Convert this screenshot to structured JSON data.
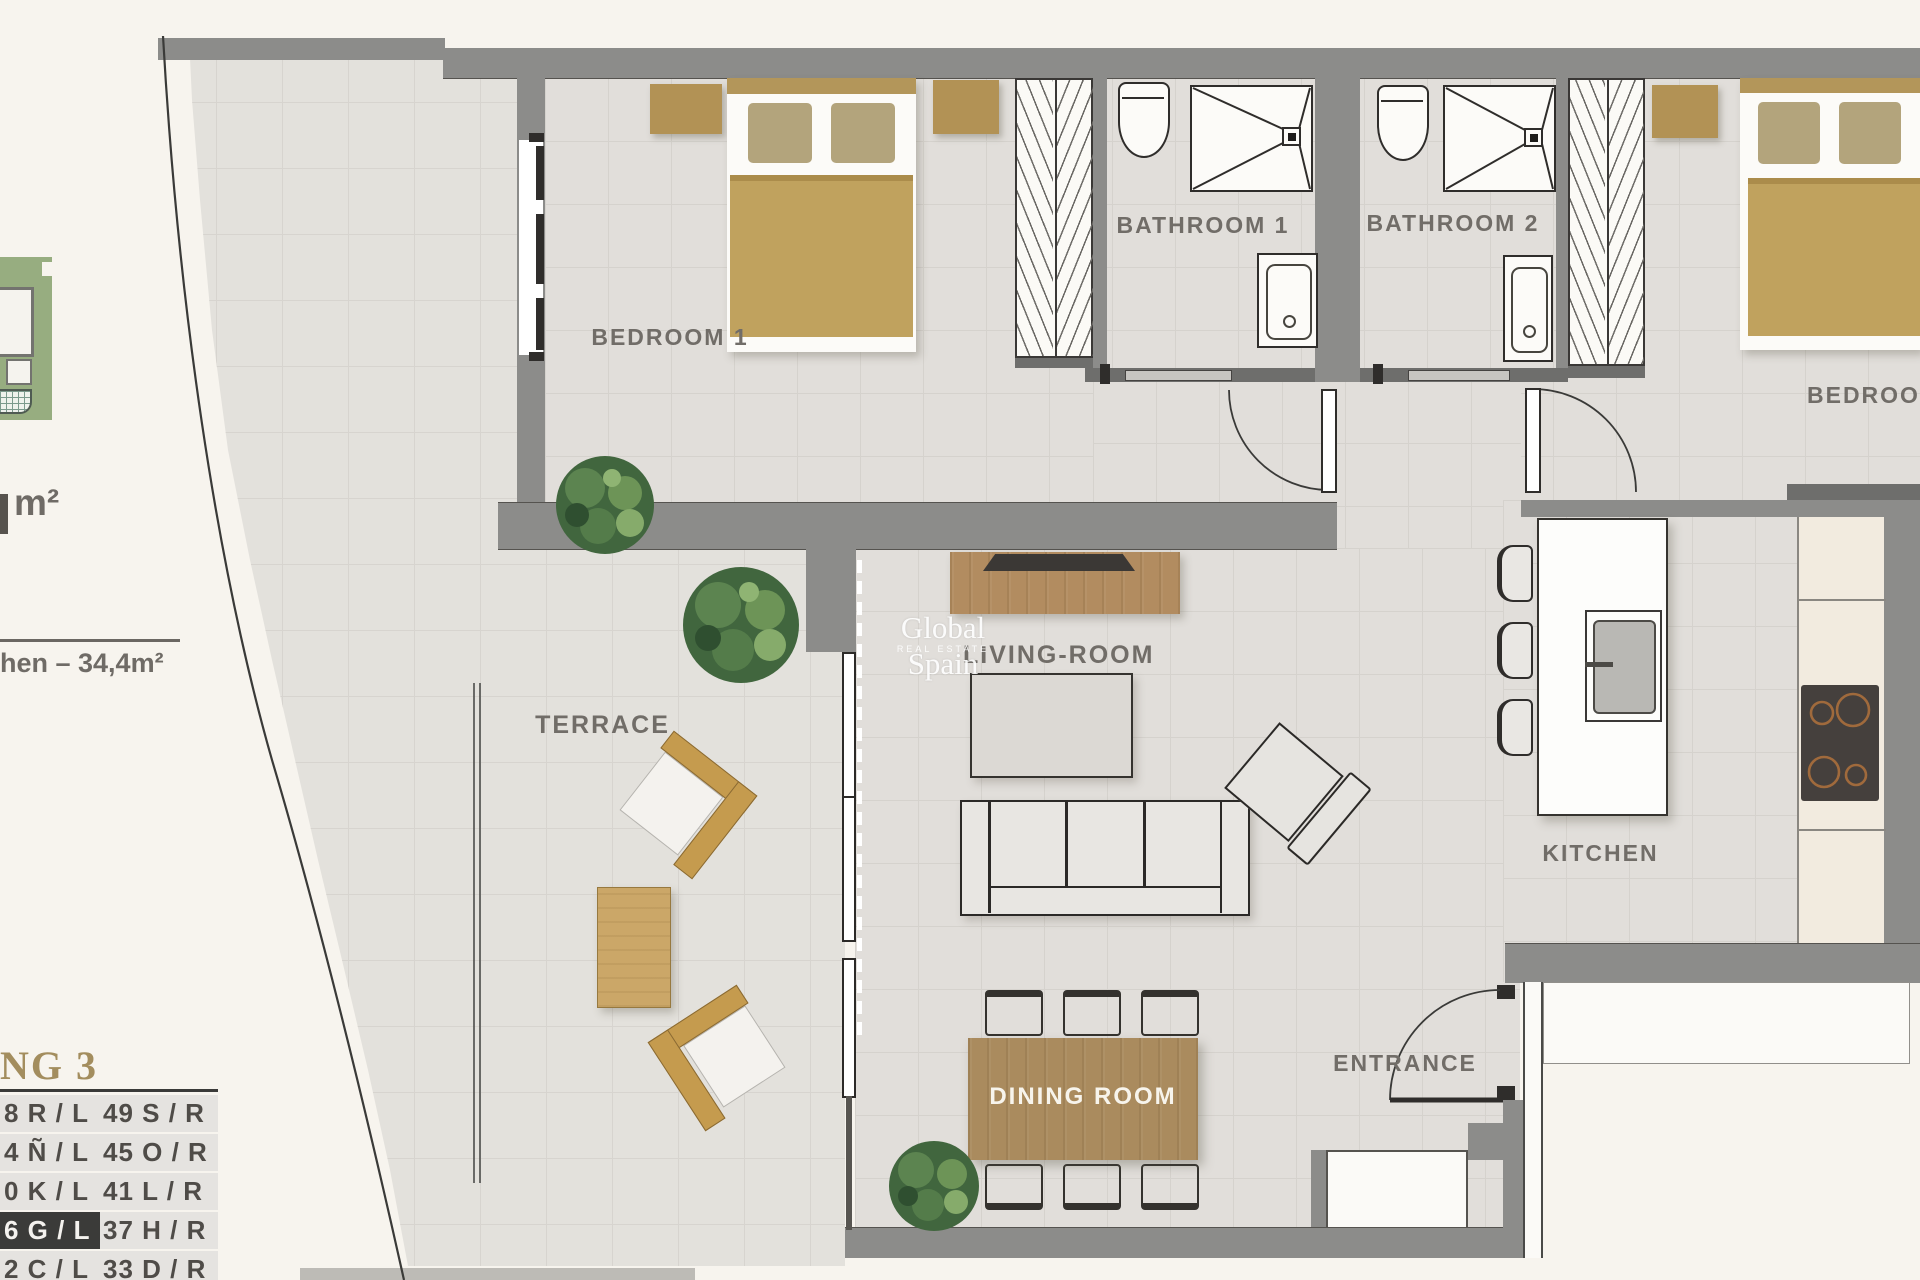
{
  "rooms": {
    "bedroom1": "BEDROOM 1",
    "bedroom2": "BEDROOM",
    "bathroom1": "BATHROOM 1",
    "bathroom2": "BATHROOM 2",
    "terrace": "TERRACE",
    "living_room": "LIVING-ROOM",
    "kitchen": "KITCHEN",
    "dining_room": "DINING ROOM",
    "entrance": "ENTRANCE"
  },
  "watermark": {
    "brand": "Global Spain",
    "tagline": "REAL ESTATE"
  },
  "side_info": {
    "area_unit_fragment": "m²",
    "kitchen_area_fragment": "hen – 34,4m²"
  },
  "building_table": {
    "title_fragment": "NG 3",
    "highlighted_row_index": 3,
    "rows": [
      {
        "left": "8 R / L",
        "right": "49 S / R"
      },
      {
        "left": "4 Ñ / L",
        "right": "45 O / R"
      },
      {
        "left": "0 K / L",
        "right": "41 L / R"
      },
      {
        "left": "6 G / L",
        "right": "37 H / R"
      },
      {
        "left": "2 C / L",
        "right": "33 D / R"
      }
    ]
  },
  "colors": {
    "wall": "#8c8c8a",
    "floor": "#e1deda",
    "accent_wood": "#aa8b5e",
    "accent_tan": "#b29255",
    "table_title_gold": "#a38d5e",
    "highlight_row": "#3b3b39"
  }
}
